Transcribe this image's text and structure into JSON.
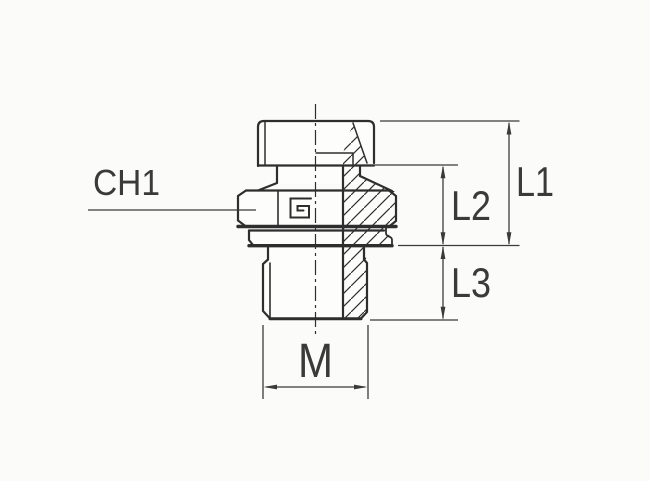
{
  "labels": {
    "wrench_size": "CH1",
    "length_overall": "L1",
    "length_body": "L2",
    "length_thread": "L3",
    "thread_size": "M"
  },
  "colors": {
    "background": "#fbfbf9",
    "part_fill": "#fdfdfb",
    "line": "#2e2e2e",
    "thick_line": "#1f1f1f",
    "dimension": "#3a3a3a",
    "text": "#3a3a3a"
  }
}
